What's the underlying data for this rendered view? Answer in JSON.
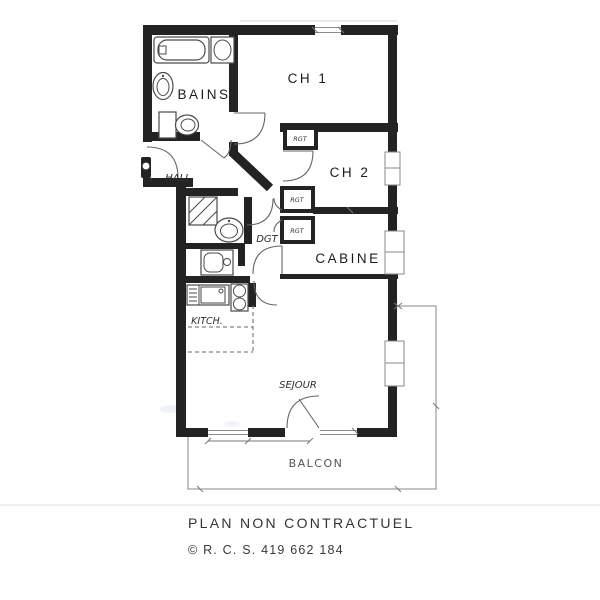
{
  "plan": {
    "rooms": [
      {
        "name": "bains",
        "label": "BAINS"
      },
      {
        "name": "ch1",
        "label": "CH 1"
      },
      {
        "name": "ch2",
        "label": "CH 2"
      },
      {
        "name": "cabine",
        "label": "CABINE"
      },
      {
        "name": "hall",
        "label": "HALL"
      },
      {
        "name": "dgt",
        "label": "DGT"
      },
      {
        "name": "kitch",
        "label": "KITCH."
      },
      {
        "name": "sejour",
        "label": "SEJOUR"
      },
      {
        "name": "balcon",
        "label": "BALCON"
      }
    ],
    "closets": [
      {
        "label": "RGT"
      },
      {
        "label": "RGT"
      },
      {
        "label": "RGT"
      }
    ],
    "fixtures": [
      "bathtub-icon",
      "washing-machine-icon",
      "pedestal-sink-icon",
      "toilet-icon",
      "shower-icon",
      "washbasin-icon",
      "vanity-basin-icon",
      "kitchen-sink-icon",
      "cooktop-icon"
    ]
  },
  "footer": {
    "disclaimer": "PLAN NON CONTRACTUEL",
    "copyright": "© R. C. S. 419 662 184"
  },
  "colors": {
    "wall": "#232323",
    "fixture_line": "#4a4a4a",
    "thin_line": "#8a8a8a",
    "label_text": "#1c1c1c",
    "footer_text": "#3a3a3a",
    "background": "#ffffff"
  }
}
